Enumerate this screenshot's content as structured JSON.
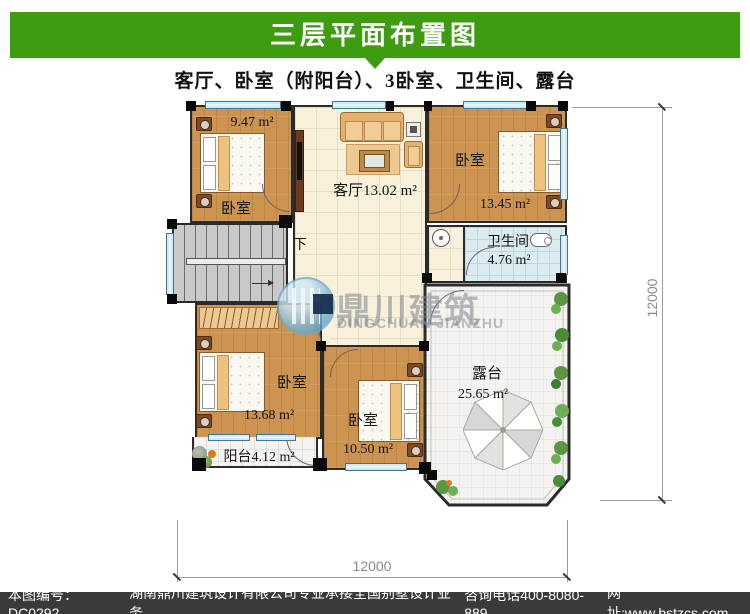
{
  "header": {
    "title": "三层平面布置图",
    "subtitle": "客厅、卧室（附阳台）、3卧室、卫生间、露台"
  },
  "plan": {
    "rooms": {
      "bedroom_tl": {
        "name": "卧室",
        "area": "9.47 m²"
      },
      "living": {
        "label": "客厅13.02 m²"
      },
      "bedroom_tr": {
        "name": "卧室",
        "area": "13.45 m²"
      },
      "bathroom": {
        "name": "卫生间",
        "area": "4.76 m²"
      },
      "bedroom_bl": {
        "name": "卧室",
        "area": "13.68 m²"
      },
      "bedroom_bc": {
        "name": "卧室",
        "area": "10.50 m²"
      },
      "balcony": {
        "label": "阳台4.12 m²"
      },
      "terrace": {
        "name": "露台",
        "area": "25.65 m²"
      },
      "stairs": {
        "down_label": "下"
      }
    },
    "dimensions": {
      "right": "12000",
      "bottom": "12000"
    }
  },
  "watermark": {
    "cn": "鼎川建筑",
    "en": "DINGCHUAN JIANZHU"
  },
  "footer": {
    "plan_no": "本图编号：DC0292",
    "company": "湖南鼎川建筑设计有限公司专业承接全国别墅设计业务",
    "phone": "咨询电话400-8080-889",
    "website": "网址:www.bstzcs.com"
  },
  "colors": {
    "header_green": "#3e9c10",
    "footer_bg": "#3a3a3a",
    "wood_floor": "#cd9451",
    "tile_floor": "#f7f1db",
    "bath_floor": "#dcebf0",
    "terrace_floor": "#f4f3f0",
    "stairs": "#c9c9c9",
    "window": "#cfeaf4",
    "watermark_gray": "#7d848e"
  }
}
